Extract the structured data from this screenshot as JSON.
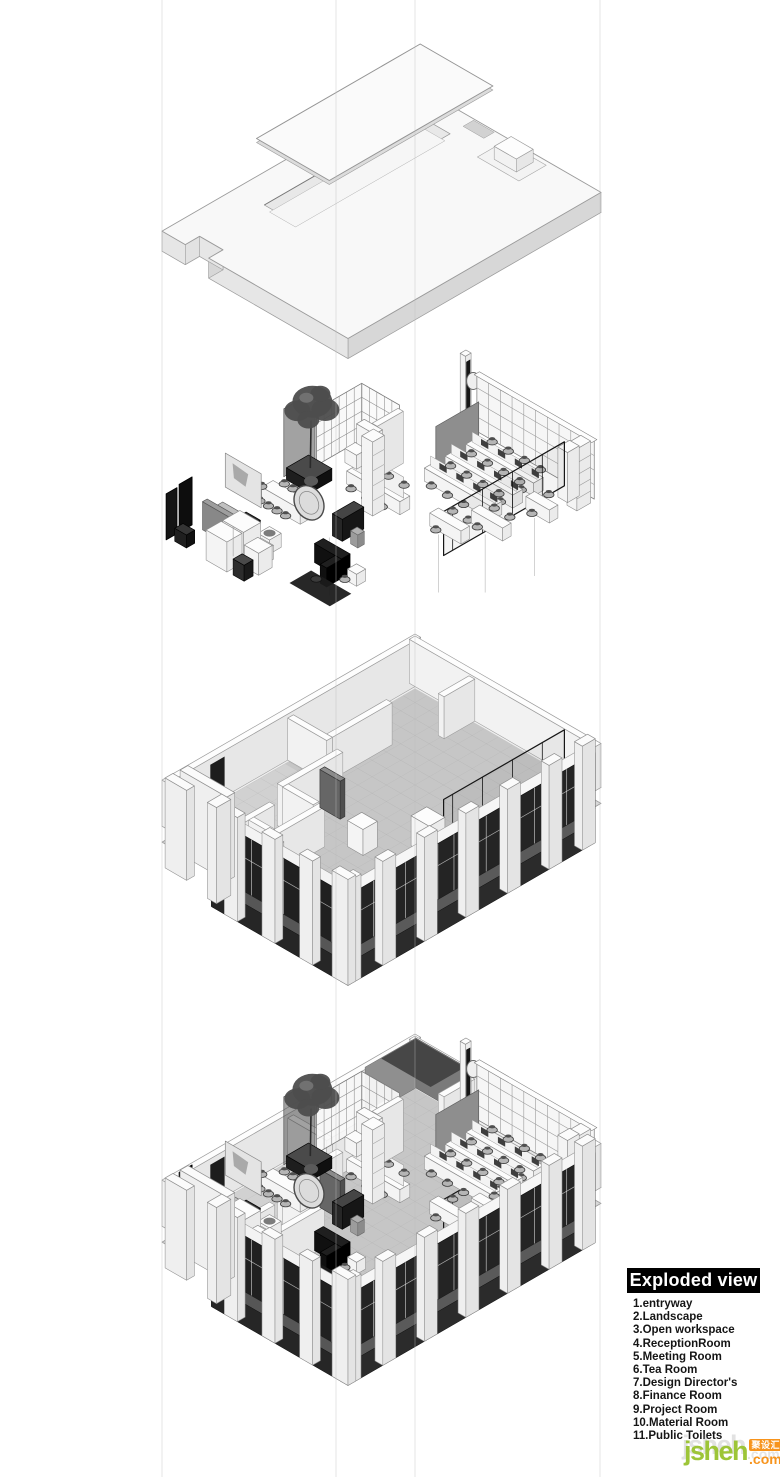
{
  "legend": {
    "title": "Exploded view",
    "bg": "#000000",
    "fg": "#ffffff",
    "items": [
      "1.entryway",
      "2.Landscape",
      "3.Open workspace",
      "4.ReceptionRoom",
      "5.Meeting Room",
      "6.Tea Room",
      "7.Design Director's",
      "8.Finance Room",
      "9.Project Room",
      "10.Material Room",
      "11.Public Toilets"
    ]
  },
  "watermark": {
    "name": "jsheh",
    "suffix": ".com",
    "cn": "聚设汇",
    "green": "#9dc538",
    "orange": "#f7941d"
  },
  "drawing": {
    "type": "architectural-exploded-axonometric",
    "layers": [
      "roof-ceiling-plate",
      "furniture-layer",
      "floor-plan-walls",
      "assembled-model"
    ],
    "palette": {
      "background": "#ffffff",
      "line": "#9a9a9a",
      "slab": "#f8f8f8",
      "floor": "#c6c6c6",
      "glazing": "#232323",
      "furniture_dark": "#141414"
    }
  }
}
